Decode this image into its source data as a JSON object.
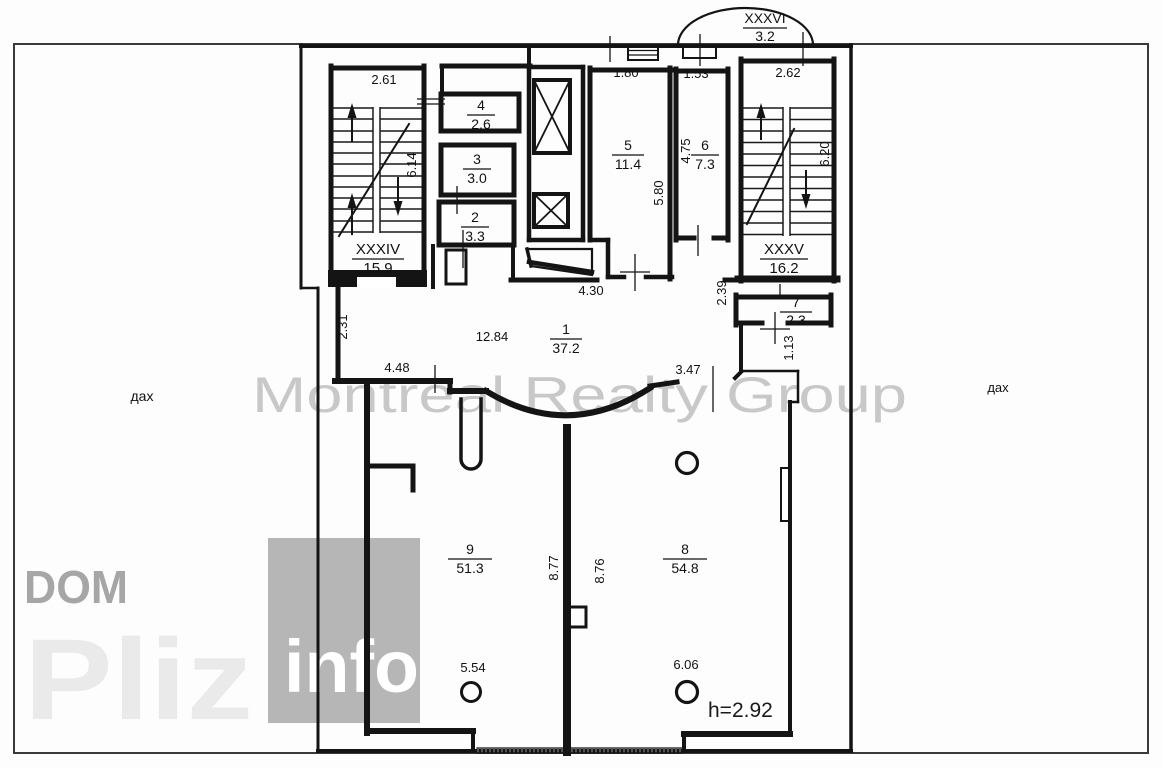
{
  "watermarks": {
    "brand": "Montreal Realty Group",
    "dom": "DOM",
    "pliz": "Pliz",
    "info": "info"
  },
  "labels": {
    "roof_left": "дах",
    "roof_right": "дах",
    "ceiling_height": "h=2.92"
  },
  "stairwells": [
    {
      "name": "XXXIV",
      "area": "15.9"
    },
    {
      "name": "XXXV",
      "area": "16.2"
    },
    {
      "name": "XXXVI",
      "area": "3.2"
    }
  ],
  "rooms": [
    {
      "number": "1",
      "area": "37.2"
    },
    {
      "number": "2",
      "area": "3.3"
    },
    {
      "number": "3",
      "area": "3.0"
    },
    {
      "number": "4",
      "area": "2.6"
    },
    {
      "number": "5",
      "area": "11.4"
    },
    {
      "number": "6",
      "area": "7.3"
    },
    {
      "number": "7",
      "area": "2.3"
    },
    {
      "number": "8",
      "area": "54.8"
    },
    {
      "number": "9",
      "area": "51.3"
    }
  ],
  "dimensions": {
    "stair_left_width": "2.61",
    "stair_left_height": "6.14",
    "stair_right_width": "2.62",
    "stair_right_height": "6.20",
    "room5_width": "1.80",
    "room5_height": "5.80",
    "room6_width": "1.53",
    "room6_height": "4.75",
    "hall_top": "4.30",
    "hall_width": "12.84",
    "hall_left": "2.31",
    "hall_bottom_left": "4.48",
    "hall_bottom_right": "3.47",
    "passage_right": "2.39",
    "niche_height": "1.13",
    "room9_height": "8.77",
    "room8_height": "8.76",
    "room9_column": "5.54",
    "room8_column": "6.06"
  },
  "colors": {
    "wall": "#141414",
    "outer_line": "#3a3a3a",
    "watermark_gray": "#a8a8a8",
    "watermark_light": "#eaeaea",
    "info_box": "#b6b6b6"
  }
}
